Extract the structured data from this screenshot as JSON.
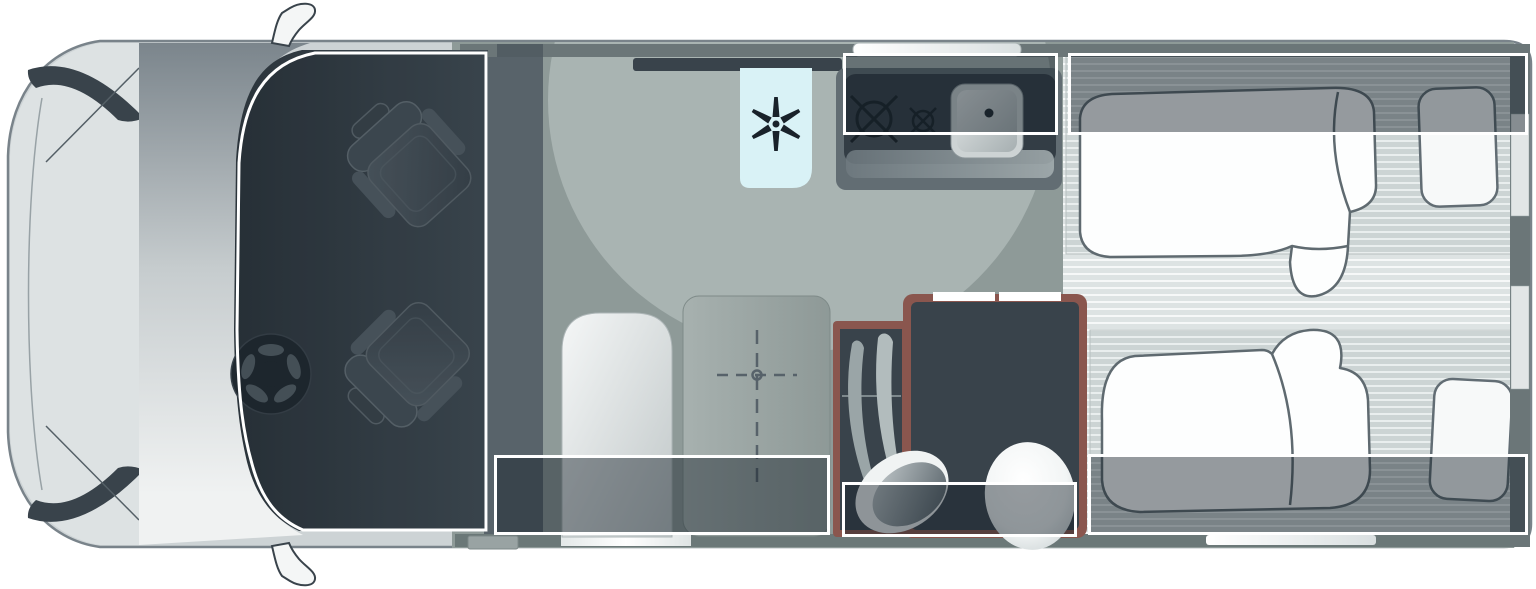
{
  "diagram": {
    "type": "motorhome-floorplan-top-view",
    "orientation": "front-of-vehicle-left",
    "text_labels": []
  },
  "colors": {
    "background": "#ffffff",
    "body_shell": "#cdd3d5",
    "body_outline": "#79838a",
    "cab_interior": "#39434b",
    "floor": "#8e9a98",
    "swivel_floor_light": "#a9b4b2",
    "wall": "#6b7678",
    "accent_trim_maroon": "#8a564e",
    "fridge_blue": "#d9f2f6",
    "mattress_stripe": "#ccd4d4",
    "overlay_fill": "rgba(22,34,43,0.45)",
    "overlay_border": "#ffffff",
    "bedding_white": "#fdfefe"
  },
  "zones": {
    "overlays": [
      {
        "name": "dinette-zone",
        "x": 494,
        "y": 455,
        "w": 336,
        "h": 80
      },
      {
        "name": "kitchen-zone",
        "x": 843,
        "y": 53,
        "w": 215,
        "h": 82
      },
      {
        "name": "rear-bed-top-zone",
        "x": 1068,
        "y": 53,
        "w": 460,
        "h": 82
      },
      {
        "name": "bathroom-zone",
        "x": 842,
        "y": 482,
        "w": 235,
        "h": 55
      },
      {
        "name": "rear-bed-bottom-zone",
        "x": 1088,
        "y": 454,
        "w": 440,
        "h": 81
      }
    ],
    "cab_zone": {
      "name": "cab-zone",
      "shape": "rounded-outline-following-windscreen"
    }
  },
  "fixtures": [
    "swivel-cab-seat-passenger",
    "swivel-cab-seat-driver",
    "steering-wheel",
    "refrigerator-with-snowflake-icon",
    "hob-two-burners",
    "kitchen-sink",
    "kitchen-window",
    "dinette-table-with-center-marker",
    "bench-seat",
    "entry-door",
    "entry-step",
    "wardrobe-with-hanging-clothes",
    "washbasin",
    "toilet",
    "single-bed-top-with-duvet-and-pillow",
    "single-bed-bottom-with-duvet-and-pillow",
    "rear-wall-windows",
    "side-mirrors"
  ],
  "icons": {
    "fridge_symbol": "snowflake-icon",
    "hob_symbols": [
      "burner-large-icon",
      "burner-small-icon"
    ],
    "table_symbol": "crosshair-center-marker-icon"
  }
}
